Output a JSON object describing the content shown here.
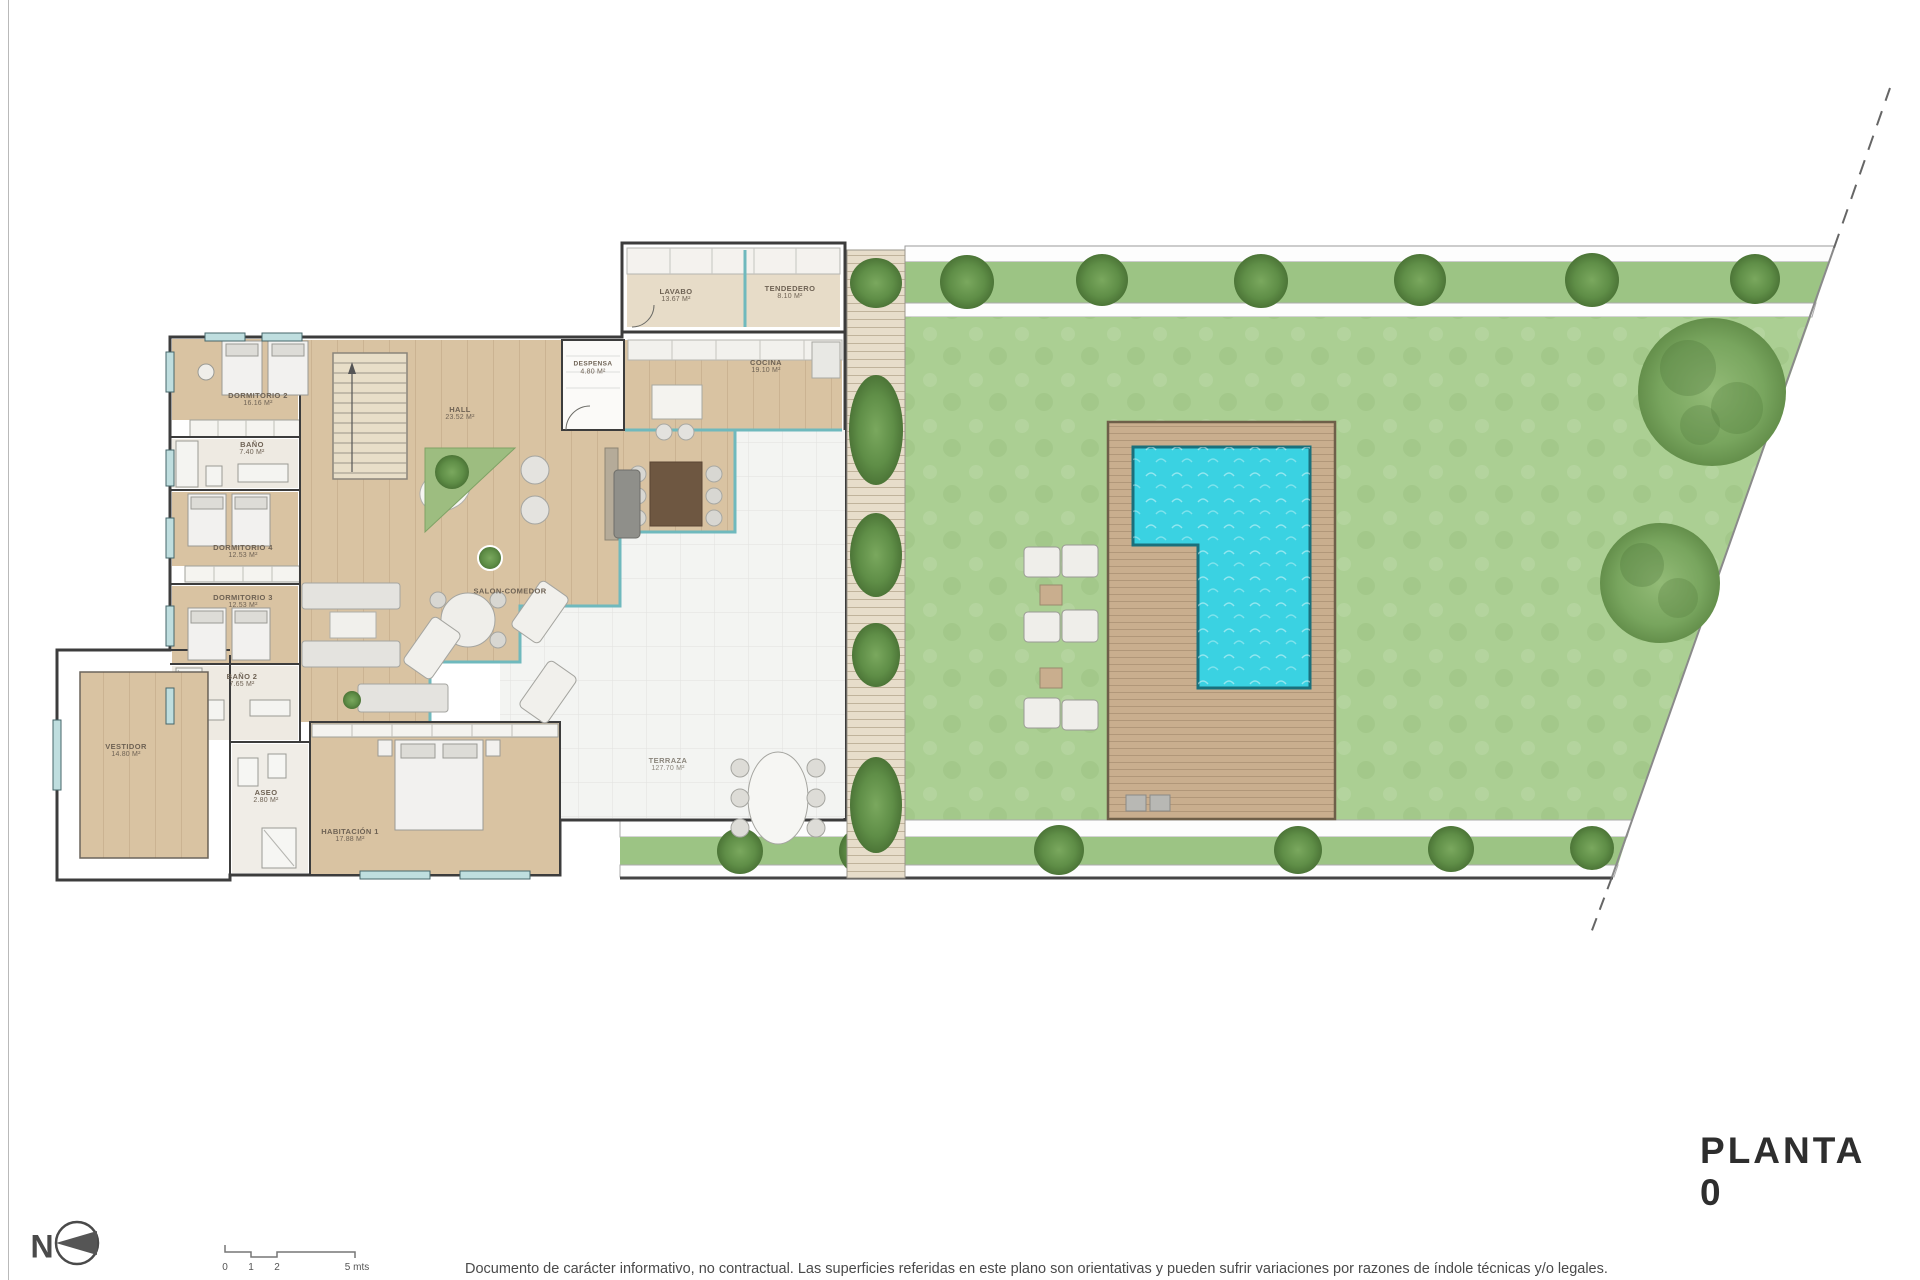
{
  "meta": {
    "title": "PLANTA 0",
    "north_label": "N"
  },
  "scale_bar": {
    "labels": [
      "0",
      "1",
      "2",
      "5 mts"
    ]
  },
  "disclaimer": "Documento de carácter informativo, no contractual. Las superficies referidas en este plano son orientativas y pueden sufrir variaciones por razones de índole técnicas y/o legales.",
  "rooms": {
    "lavabo": {
      "name": "LAVABO",
      "area": "13.67 M²"
    },
    "tendedero": {
      "name": "TENDEDERO",
      "area": "8.10 M²"
    },
    "despensa": {
      "name": "DESPENSA",
      "area": "4.80 M²"
    },
    "cocina": {
      "name": "COCINA",
      "area": "19.10 M²"
    },
    "hall": {
      "name": "HALL",
      "area": "23.52 M²"
    },
    "salon": {
      "name": "SALON-COMEDOR",
      "area": ""
    },
    "terraza": {
      "name": "TERRAZA",
      "area": "127.70 M²"
    },
    "dormitorio2": {
      "name": "DORMITORIO 2",
      "area": "16.16 M²"
    },
    "bano": {
      "name": "BAÑO",
      "area": "7.40 M²"
    },
    "dormitorio4": {
      "name": "DORMITORIO 4",
      "area": "12.53 M²"
    },
    "dormitorio3": {
      "name": "DORMITORIO 3",
      "area": "12.53 M²"
    },
    "bano2": {
      "name": "BAÑO 2",
      "area": "7.65 M²"
    },
    "vestidor": {
      "name": "VESTIDOR",
      "area": "14.80 M²"
    },
    "aseo": {
      "name": "ASEO",
      "area": "2.80 M²"
    },
    "habitacion1": {
      "name": "HABITACIÓN 1",
      "area": "17.88 M²"
    }
  },
  "colors": {
    "wood": "#d9c3a2",
    "terrace_tile": "#f3f4f2",
    "lawn": "#abcf93",
    "pool_water": "#3ad2e2",
    "deck": "#c9ae8e",
    "wall": "#3c3c3c",
    "glass": "#6fb9bd"
  }
}
